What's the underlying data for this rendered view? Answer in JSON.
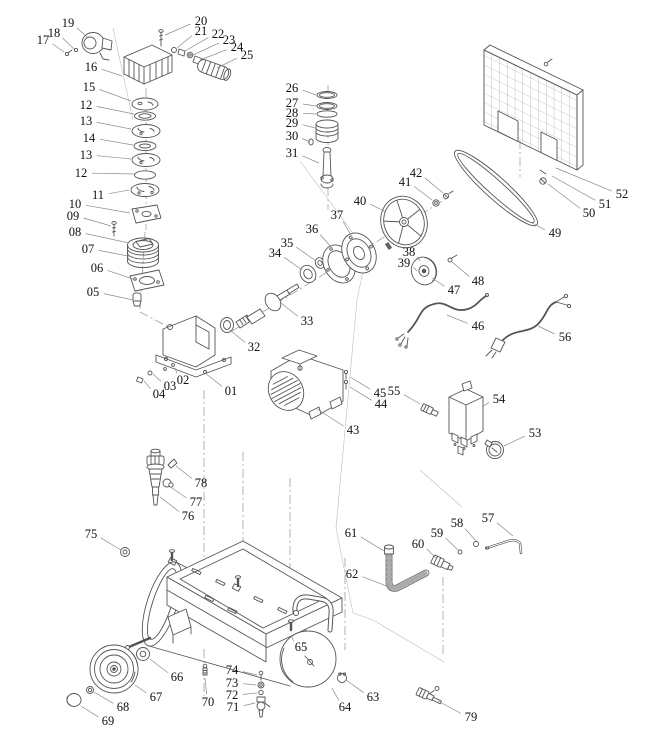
{
  "diagram": {
    "type": "exploded-parts-diagram",
    "canvas": {
      "width": 649,
      "height": 755
    },
    "colors": {
      "background": "#ffffff",
      "line": "#555555",
      "leader": "#8a8a8a",
      "axis": "#9b9b9b",
      "boundary": "#bdbdbd",
      "text": "#111111"
    },
    "label_font_size": 12.5,
    "labels": [
      {
        "n": "01",
        "x": 231,
        "y": 391,
        "tx": 205,
        "ty": 373
      },
      {
        "n": "02",
        "x": 183,
        "y": 380,
        "tx": 175,
        "ty": 368
      },
      {
        "n": "03",
        "x": 170,
        "y": 386,
        "tx": 153,
        "ty": 374
      },
      {
        "n": "04",
        "x": 159,
        "y": 394,
        "tx": 144,
        "ty": 381
      },
      {
        "n": "05",
        "x": 93,
        "y": 292,
        "tx": 133,
        "ty": 300
      },
      {
        "n": "06",
        "x": 97,
        "y": 268,
        "tx": 136,
        "ty": 280
      },
      {
        "n": "07",
        "x": 88,
        "y": 249,
        "tx": 133,
        "ty": 257
      },
      {
        "n": "08",
        "x": 75,
        "y": 232,
        "tx": 129,
        "ty": 243
      },
      {
        "n": "09",
        "x": 73,
        "y": 216,
        "tx": 111,
        "ty": 226
      },
      {
        "n": "10",
        "x": 75,
        "y": 204,
        "tx": 130,
        "ty": 213
      },
      {
        "n": "11",
        "x": 98,
        "y": 195,
        "tx": 129,
        "ty": 190
      },
      {
        "n": "12",
        "x": 86,
        "y": 105,
        "tx": 134,
        "ty": 114
      },
      {
        "n": "13",
        "x": 86,
        "y": 121,
        "tx": 131,
        "ty": 129
      },
      {
        "n": "14",
        "x": 89,
        "y": 138,
        "tx": 133,
        "ty": 145
      },
      {
        "n": "13",
        "x": 86,
        "y": 155,
        "tx": 131,
        "ty": 159
      },
      {
        "n": "12",
        "x": 81,
        "y": 173,
        "tx": 134,
        "ty": 174
      },
      {
        "n": "15",
        "x": 89,
        "y": 87,
        "tx": 131,
        "ty": 101
      },
      {
        "n": "16",
        "x": 91,
        "y": 67,
        "tx": 122,
        "ty": 76
      },
      {
        "n": "17",
        "x": 43,
        "y": 40,
        "tx": 64,
        "ty": 52
      },
      {
        "n": "18",
        "x": 54,
        "y": 33,
        "tx": 74,
        "ty": 49
      },
      {
        "n": "19",
        "x": 68,
        "y": 23,
        "tx": 87,
        "ty": 37
      },
      {
        "n": "20",
        "x": 201,
        "y": 21,
        "tx": 165,
        "ty": 35
      },
      {
        "n": "21",
        "x": 201,
        "y": 31,
        "tx": 177,
        "ty": 48
      },
      {
        "n": "22",
        "x": 218,
        "y": 34,
        "tx": 185,
        "ty": 51
      },
      {
        "n": "23",
        "x": 229,
        "y": 40,
        "tx": 193,
        "ty": 55
      },
      {
        "n": "24",
        "x": 237,
        "y": 47,
        "tx": 200,
        "ty": 60
      },
      {
        "n": "25",
        "x": 247,
        "y": 55,
        "tx": 217,
        "ty": 68
      },
      {
        "n": "26",
        "x": 292,
        "y": 88,
        "tx": 316,
        "ty": 95
      },
      {
        "n": "27",
        "x": 292,
        "y": 103,
        "tx": 316,
        "ty": 106
      },
      {
        "n": "28",
        "x": 292,
        "y": 113,
        "tx": 316,
        "ty": 114
      },
      {
        "n": "29",
        "x": 292,
        "y": 123,
        "tx": 315,
        "ty": 128
      },
      {
        "n": "30",
        "x": 292,
        "y": 136,
        "tx": 310,
        "ty": 142
      },
      {
        "n": "31",
        "x": 292,
        "y": 153,
        "tx": 319,
        "ty": 163
      },
      {
        "n": "32",
        "x": 254,
        "y": 347,
        "tx": 230,
        "ty": 330
      },
      {
        "n": "33",
        "x": 307,
        "y": 321,
        "tx": 281,
        "ty": 303
      },
      {
        "n": "34",
        "x": 275,
        "y": 253,
        "tx": 302,
        "ty": 270
      },
      {
        "n": "35",
        "x": 287,
        "y": 243,
        "tx": 316,
        "ty": 261
      },
      {
        "n": "36",
        "x": 312,
        "y": 229,
        "tx": 332,
        "ty": 248
      },
      {
        "n": "37",
        "x": 337,
        "y": 215,
        "tx": 352,
        "ty": 237
      },
      {
        "n": "38",
        "x": 409,
        "y": 252,
        "tx": 420,
        "ty": 261
      },
      {
        "n": "39",
        "x": 404,
        "y": 263,
        "tx": 417,
        "ty": 271
      },
      {
        "n": "40",
        "x": 360,
        "y": 201,
        "tx": 386,
        "ty": 212
      },
      {
        "n": "41",
        "x": 405,
        "y": 182,
        "tx": 432,
        "ty": 200
      },
      {
        "n": "42",
        "x": 416,
        "y": 173,
        "tx": 443,
        "ty": 193
      },
      {
        "n": "43",
        "x": 353,
        "y": 430,
        "tx": 317,
        "ty": 409
      },
      {
        "n": "44",
        "x": 381,
        "y": 404,
        "tx": 350,
        "ty": 387
      },
      {
        "n": "45",
        "x": 380,
        "y": 393,
        "tx": 350,
        "ty": 377
      },
      {
        "n": "46",
        "x": 478,
        "y": 326,
        "tx": 447,
        "ty": 315
      },
      {
        "n": "47",
        "x": 454,
        "y": 290,
        "tx": 432,
        "ty": 278
      },
      {
        "n": "48",
        "x": 478,
        "y": 281,
        "tx": 452,
        "ty": 262
      },
      {
        "n": "49",
        "x": 555,
        "y": 233,
        "tx": 532,
        "ty": 223
      },
      {
        "n": "50",
        "x": 589,
        "y": 213,
        "tx": 548,
        "ty": 184
      },
      {
        "n": "51",
        "x": 605,
        "y": 204,
        "tx": 552,
        "ty": 176
      },
      {
        "n": "52",
        "x": 622,
        "y": 194,
        "tx": 556,
        "ty": 168
      },
      {
        "n": "53",
        "x": 535,
        "y": 433,
        "tx": 504,
        "ty": 446
      },
      {
        "n": "54",
        "x": 499,
        "y": 399,
        "tx": 482,
        "ty": 407
      },
      {
        "n": "55",
        "x": 394,
        "y": 391,
        "tx": 420,
        "ty": 404
      },
      {
        "n": "56",
        "x": 565,
        "y": 337,
        "tx": 538,
        "ty": 326
      },
      {
        "n": "57",
        "x": 488,
        "y": 518,
        "tx": 513,
        "ty": 536
      },
      {
        "n": "58",
        "x": 457,
        "y": 523,
        "tx": 476,
        "ty": 541
      },
      {
        "n": "59",
        "x": 437,
        "y": 533,
        "tx": 458,
        "ty": 550
      },
      {
        "n": "60",
        "x": 418,
        "y": 544,
        "tx": 436,
        "ty": 558
      },
      {
        "n": "61",
        "x": 351,
        "y": 533,
        "tx": 384,
        "ty": 551
      },
      {
        "n": "62",
        "x": 352,
        "y": 574,
        "tx": 389,
        "ty": 587
      },
      {
        "n": "63",
        "x": 373,
        "y": 697,
        "tx": 346,
        "ty": 680
      },
      {
        "n": "64",
        "x": 345,
        "y": 707,
        "tx": 332,
        "ty": 688
      },
      {
        "n": "65",
        "x": 301,
        "y": 647,
        "tx": 292,
        "ty": 637
      },
      {
        "n": "66",
        "x": 177,
        "y": 677,
        "tx": 150,
        "ty": 659
      },
      {
        "n": "67",
        "x": 156,
        "y": 697,
        "tx": 135,
        "ty": 685
      },
      {
        "n": "68",
        "x": 123,
        "y": 707,
        "tx": 94,
        "ty": 692
      },
      {
        "n": "69",
        "x": 108,
        "y": 721,
        "tx": 81,
        "ty": 706
      },
      {
        "n": "70",
        "x": 208,
        "y": 702,
        "tx": 205,
        "ty": 678
      },
      {
        "n": "71",
        "x": 233,
        "y": 707,
        "tx": 255,
        "ty": 703
      },
      {
        "n": "72",
        "x": 232,
        "y": 695,
        "tx": 257,
        "ty": 693
      },
      {
        "n": "73",
        "x": 232,
        "y": 683,
        "tx": 256,
        "ty": 685
      },
      {
        "n": "74",
        "x": 232,
        "y": 670,
        "tx": 257,
        "ty": 675
      },
      {
        "n": "75",
        "x": 91,
        "y": 534,
        "tx": 121,
        "ty": 550
      },
      {
        "n": "76",
        "x": 188,
        "y": 516,
        "tx": 160,
        "ty": 497
      },
      {
        "n": "77",
        "x": 196,
        "y": 502,
        "tx": 172,
        "ty": 488
      },
      {
        "n": "78",
        "x": 201,
        "y": 483,
        "tx": 176,
        "ty": 466
      },
      {
        "n": "79",
        "x": 471,
        "y": 717,
        "tx": 438,
        "ty": 701
      }
    ],
    "axis_lines": [
      [
        146,
        88,
        146,
        230
      ],
      [
        145,
        232,
        140,
        310
      ],
      [
        140,
        312,
        176,
        331
      ],
      [
        328,
        85,
        328,
        210
      ],
      [
        232,
        331,
        449,
        197
      ],
      [
        204,
        390,
        204,
        562
      ],
      [
        204,
        649,
        204,
        696
      ],
      [
        243,
        452,
        243,
        582
      ],
      [
        290,
        478,
        290,
        623
      ],
      [
        345,
        558,
        345,
        650
      ],
      [
        443,
        577,
        443,
        655
      ],
      [
        520,
        140,
        520,
        177
      ]
    ],
    "boundary_lines": [
      [
        113,
        28,
        133,
        120
      ],
      [
        300,
        161,
        367,
        252
      ],
      [
        367,
        252,
        357,
        300
      ],
      [
        357,
        300,
        336,
        528
      ],
      [
        336,
        528,
        353,
        613
      ],
      [
        353,
        613,
        373,
        620
      ],
      [
        373,
        620,
        444,
        662
      ],
      [
        420,
        470,
        462,
        507
      ]
    ]
  }
}
